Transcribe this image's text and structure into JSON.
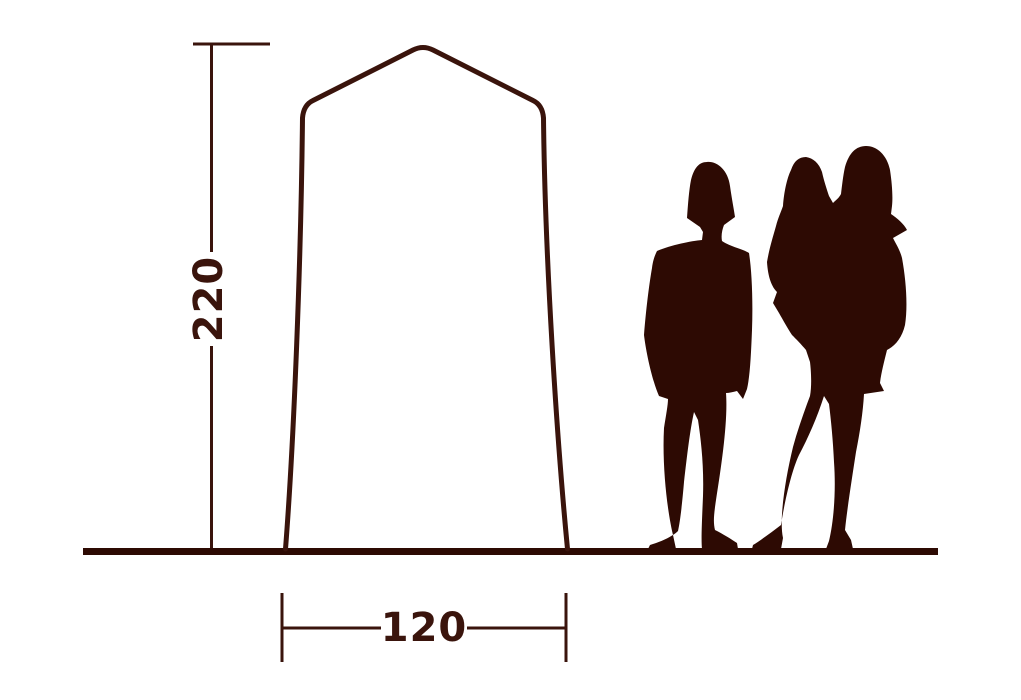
{
  "diagram": {
    "kind": "dimension-diagram",
    "height_label": "220",
    "width_label": "120",
    "colors": {
      "background": "#ffffff",
      "line": "#3a140c",
      "outline": "#3a140c",
      "text": "#3a140c",
      "ground": "#2d0a03",
      "silhouette": "#2d0a03"
    },
    "figures": {
      "left": "standing-adult-silhouette",
      "right": "adult-holding-child-silhouette"
    }
  }
}
